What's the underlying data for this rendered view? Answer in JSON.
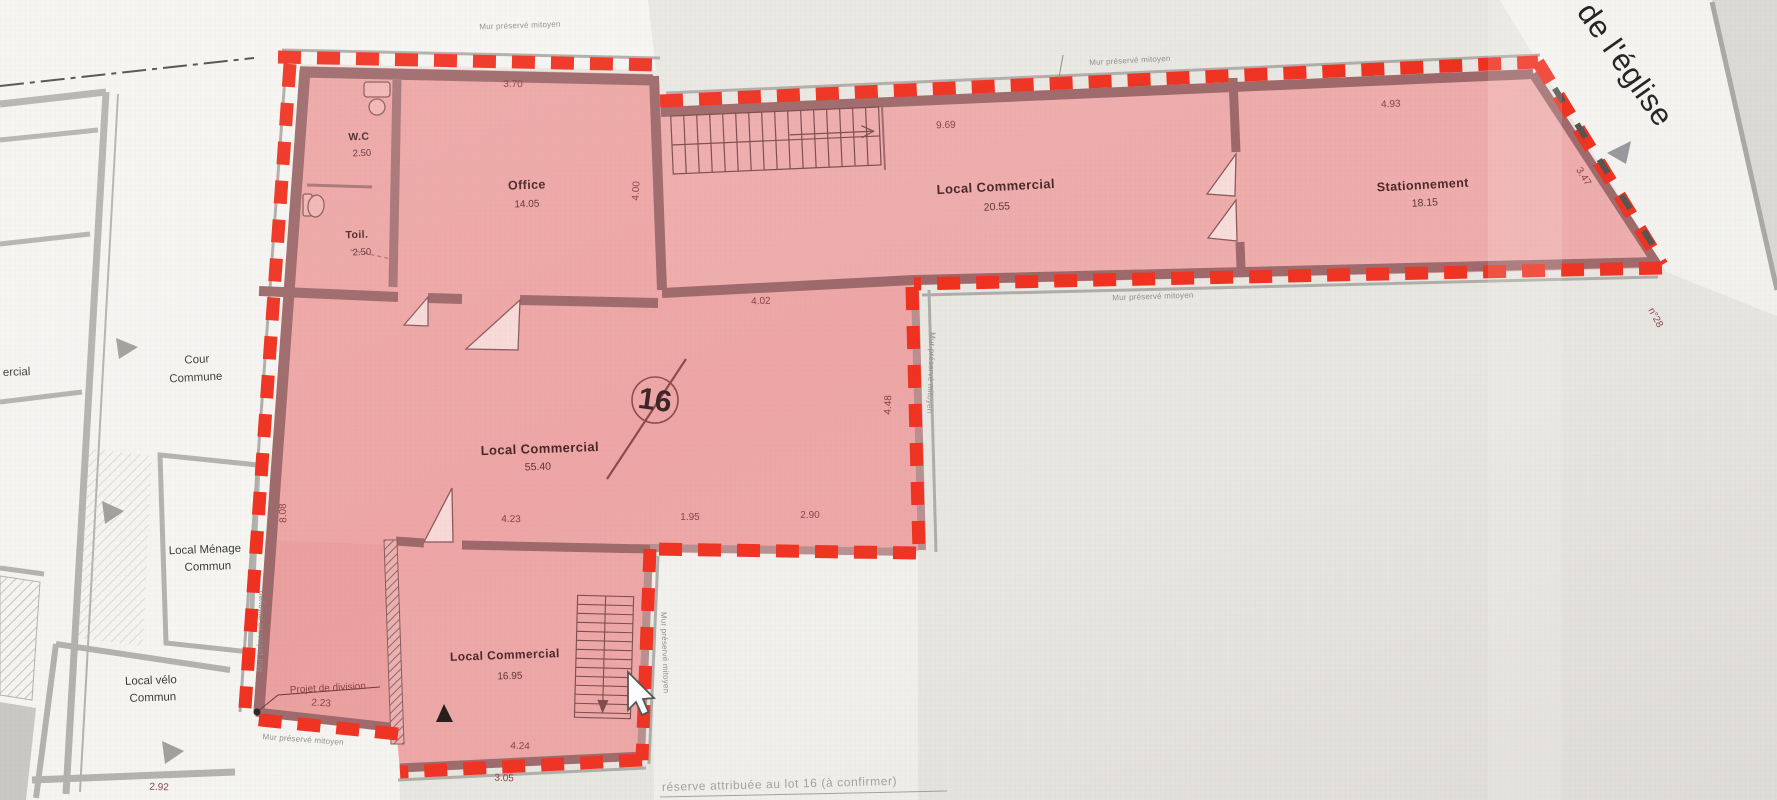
{
  "colors": {
    "paper": "#e9e7e2",
    "lot_fill": "#eda2a1",
    "boundary_red": "#f0301f",
    "wall": "#9e686a",
    "neighbor_wall": "#b3b2ae"
  },
  "street": {
    "name_partial": "de l'église",
    "house_number": "n°28"
  },
  "lot": {
    "number": "16"
  },
  "rooms": {
    "wc": {
      "name": "W.C",
      "area": "2.50"
    },
    "toilet": {
      "name": "Toil.",
      "area": "2.50"
    },
    "office": {
      "name": "Office",
      "area": "14.05"
    },
    "commercial_main": {
      "name": "Local Commercial",
      "area": "55.40"
    },
    "commercial_upper": {
      "name": "Local Commercial",
      "area": "20.55"
    },
    "parking": {
      "name": "Stationnement",
      "area": "18.15"
    },
    "commercial_lower": {
      "name": "Local Commercial",
      "area": "16.95"
    }
  },
  "neighbors": {
    "courtyard_line1": "Cour",
    "courtyard_line2": "Commune",
    "cleaning_line1": "Local Ménage",
    "cleaning_line2": "Commun",
    "bike_line1": "Local vélo",
    "bike_line2": "Commun",
    "edge_partial": "ercial"
  },
  "dimensions": {
    "d370": "3.70",
    "d400": "4.00",
    "d969": "9.69",
    "d493": "4.93",
    "d347": "3.47",
    "d402": "4.02",
    "d448": "4.48",
    "d423": "4.23",
    "d195": "1.95",
    "d290": "2.90",
    "d808": "8.08",
    "d223": "2.23",
    "d424": "4.24",
    "d305": "3.05",
    "d292": "2.92"
  },
  "annotations": {
    "party_wall": "Mur préservé mitoyen",
    "division": "Projet de division",
    "reserve_note": "réserve attribuée au lot 16 (à confirmer)"
  }
}
